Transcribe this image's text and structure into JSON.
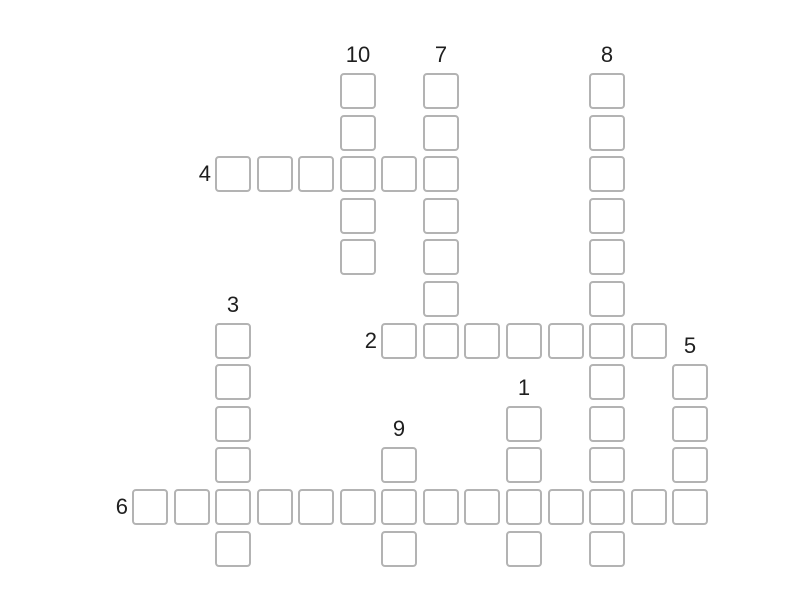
{
  "page": {
    "background_color": "#ffffff"
  },
  "puzzle": {
    "kind": "crossword-grid",
    "cells_empty": true,
    "colors": {
      "cell_border": "#b3b3b3",
      "cell_fill": "#ffffff",
      "clue_number": "#1f1f1f"
    },
    "grid": {
      "origin_x": 132,
      "origin_y": 73,
      "pitch_x": 41.55,
      "pitch_y": 41.6,
      "cell_size": 36
    },
    "words": [
      {
        "number": "10",
        "direction": "down",
        "col": 5,
        "row": 0,
        "length": 5
      },
      {
        "number": "7",
        "direction": "down",
        "col": 7,
        "row": 0,
        "length": 7
      },
      {
        "number": "8",
        "direction": "down",
        "col": 11,
        "row": 0,
        "length": 12
      },
      {
        "number": "4",
        "direction": "across",
        "col": 2,
        "row": 2,
        "length": 6
      },
      {
        "number": "2",
        "direction": "across",
        "col": 6,
        "row": 6,
        "length": 7
      },
      {
        "number": "3",
        "direction": "down",
        "col": 2,
        "row": 6,
        "length": 6
      },
      {
        "number": "5",
        "direction": "down",
        "col": 13,
        "row": 7,
        "length": 4
      },
      {
        "number": "1",
        "direction": "down",
        "col": 9,
        "row": 8,
        "length": 4
      },
      {
        "number": "9",
        "direction": "down",
        "col": 6,
        "row": 9,
        "length": 3
      },
      {
        "number": "6",
        "direction": "across",
        "col": 0,
        "row": 10,
        "length": 14
      }
    ]
  }
}
